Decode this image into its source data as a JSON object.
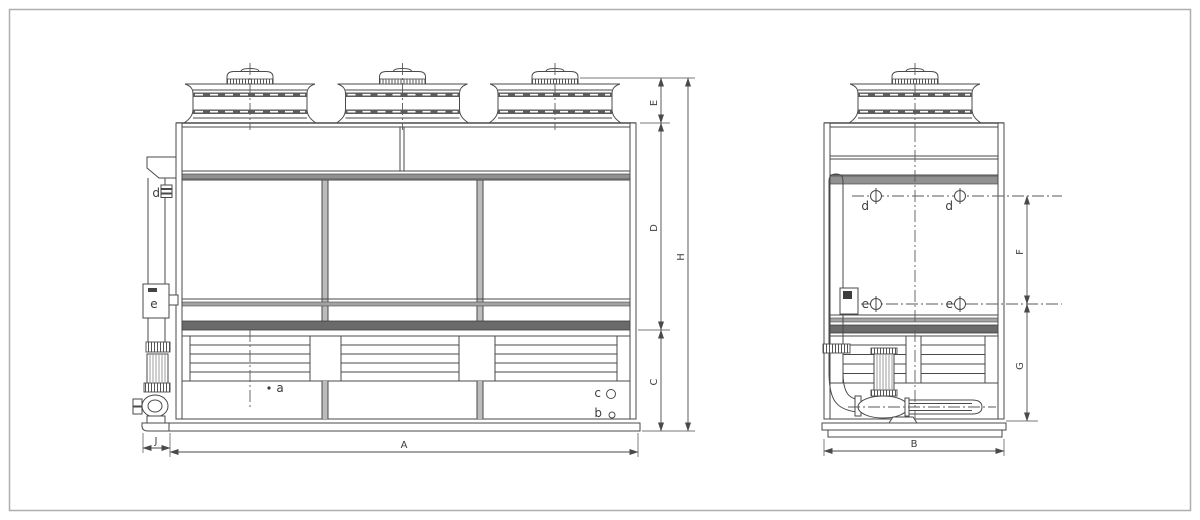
{
  "colors": {
    "background": "#ffffff",
    "line": "#4a4a4a",
    "band_dark": "#6a6a6a",
    "band_mid": "#919191",
    "band_light": "#a3a3a3",
    "centerline": "#5a5a5a",
    "frame_border": "#aeaeae"
  },
  "front_view": {
    "dims": {
      "E": "E",
      "D": "D",
      "C": "C",
      "H": "H",
      "A": "A",
      "J": "J"
    },
    "ports": {
      "d": "d",
      "e": "e",
      "a": "a",
      "b": "b",
      "c": "c"
    }
  },
  "side_view": {
    "dims": {
      "F": "F",
      "G": "G",
      "B": "B"
    },
    "ports": {
      "d_left": "d",
      "d_right": "d",
      "e_left": "e",
      "e_right": "e"
    }
  }
}
